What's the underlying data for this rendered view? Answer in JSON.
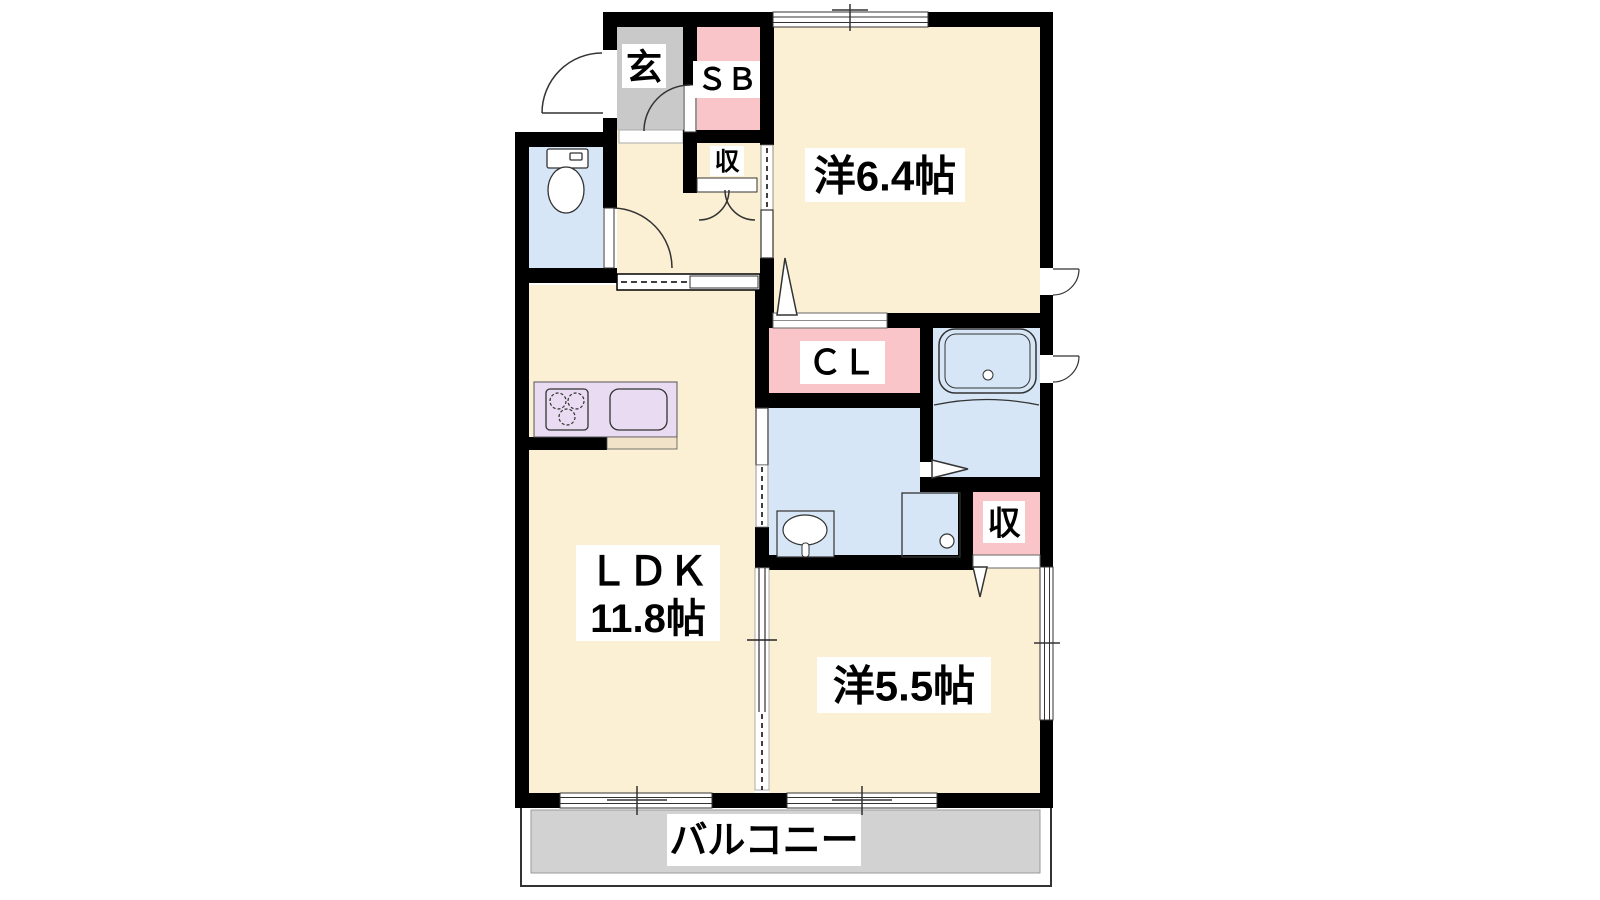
{
  "plan": {
    "title": "apartment-floor-plan",
    "rooms": {
      "genkan": {
        "label": "玄"
      },
      "shoebox": {
        "label": "ＳＢ"
      },
      "storage_upper": {
        "label": "収"
      },
      "western_room_1": {
        "label": "洋6.4帖"
      },
      "closet": {
        "label": "ＣＬ"
      },
      "storage_lower": {
        "label": "収"
      },
      "ldk": {
        "label": "ＬＤＫ",
        "size": "11.8帖"
      },
      "western_room_2": {
        "label": "洋5.5帖"
      },
      "balcony": {
        "label": "バルコニー"
      }
    },
    "fixtures": [
      "toilet-icon",
      "bathtub-icon",
      "washbasin-icon",
      "washing-machine-pan-icon",
      "stove-icon",
      "kitchen-sink-icon",
      "door-swing-icon",
      "sliding-door-icon",
      "window-icon"
    ],
    "colors": {
      "floor_cream": "#FBF0D3",
      "genkan_gray": "#C9C9C9",
      "closet_pink": "#F9C5C8",
      "wet_area_blue": "#D6E6F6",
      "kitchen_lavender": "#E9DCF2",
      "counter_beige": "#F2E3C8",
      "balcony_gray": "#D2D2D2",
      "wall": "#000000"
    }
  }
}
